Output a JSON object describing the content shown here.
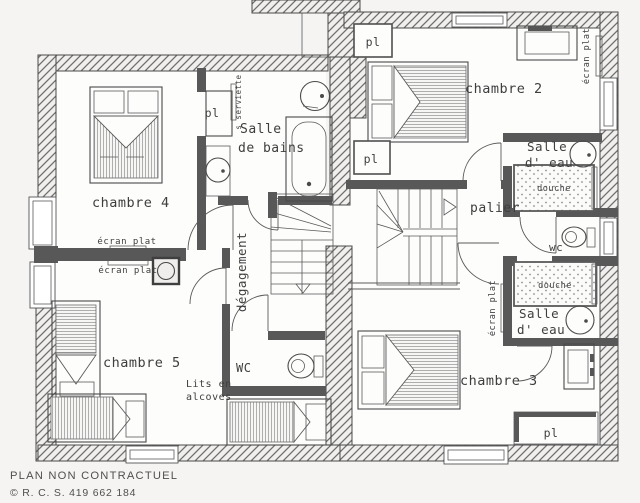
{
  "plan": {
    "rooms": {
      "chambre4": "chambre 4",
      "chambre5": "chambre 5",
      "chambre2": "chambre 2",
      "chambre3": "chambre 3",
      "salle_de_bains_l1": "Salle",
      "salle_de_bains_l2": "de bains",
      "salle_eau_top_l1": "Salle",
      "salle_eau_top_l2": "d' eau",
      "salle_eau_bottom_l1": "Salle",
      "salle_eau_bottom_l2": "d' eau",
      "palier": "palier",
      "degagement": "dégagement",
      "wc_left": "WC",
      "wc_right": "wc"
    },
    "labels": {
      "pl_sdb": "pl",
      "pl_ch2_top": "pl",
      "pl_ch2_mid": "pl",
      "pl_ch3": "pl",
      "ecran_plat_ch4": "écran plat",
      "ecran_plat_ch5": "écran plat",
      "ecran_plat_ch2": "écran plat",
      "ecran_plat_ch3": "écran plat",
      "seche_serviette": "s serviette",
      "douche_top": "douche",
      "douche_bottom": "douche",
      "lits_l1": "Lits en",
      "lits_l2": "alcoves"
    },
    "footer": {
      "line1": "PLAN NON CONTRACTUEL",
      "line2": "© R. C. S. 419 662 184"
    },
    "colors": {
      "paper": "#f5f4f2",
      "floor": "#fdfdfc",
      "line": "#4a4a4a",
      "interior_wall": "#585858",
      "text": "#3e3e3e"
    }
  }
}
